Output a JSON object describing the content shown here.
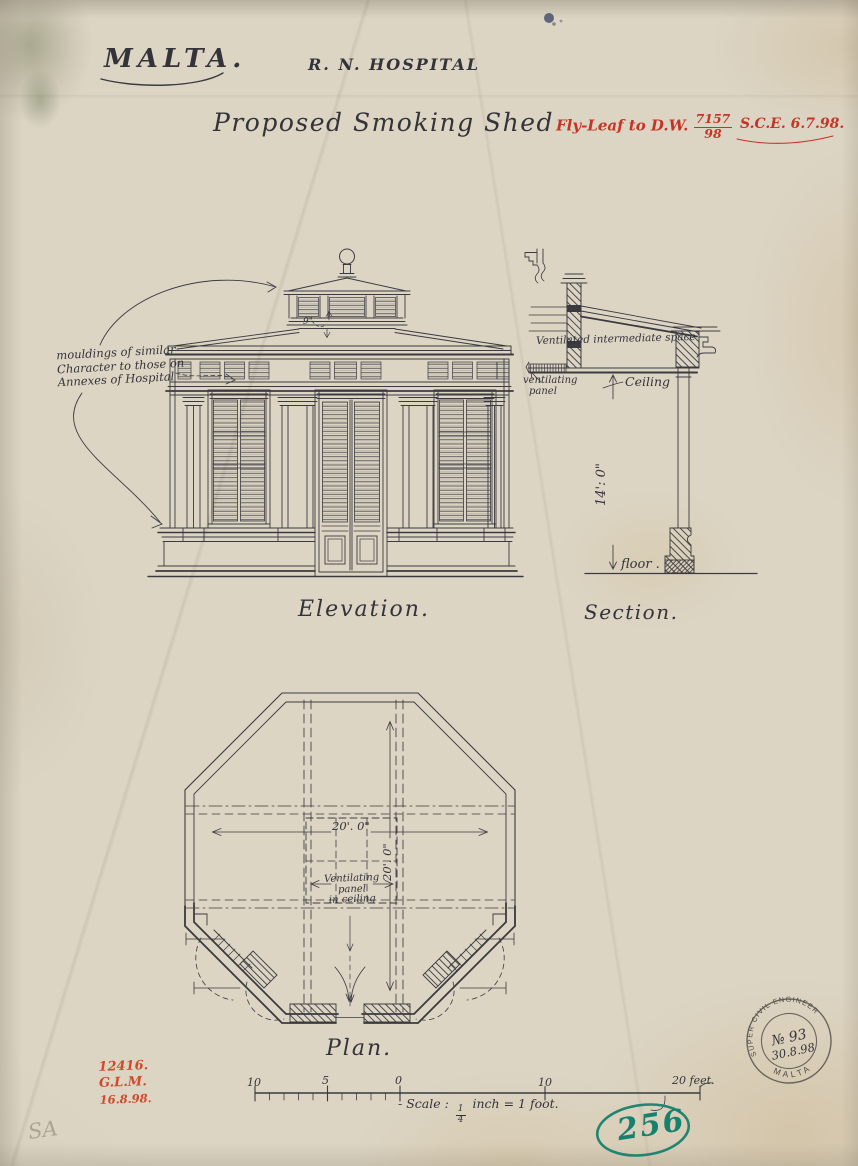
{
  "header": {
    "location": "MALTA.",
    "institution": "R. N. HOSPITAL",
    "title": "Proposed  Smoking  Shed",
    "fly_leaf_label": "Fly-Leaf to D.W.",
    "fly_leaf_num": "7157",
    "fly_leaf_den": "98",
    "sce_note": "S.C.E. 6.7.98."
  },
  "elevation": {
    "label": "Elevation.",
    "note_line1": "mouldings of similar",
    "note_line2": "Character to those on",
    "note_line3": "Annexes of Hospital",
    "roof_dim": "9\""
  },
  "section": {
    "label": "Section.",
    "note_space": "Ventilated intermediate space",
    "note_panel_line1": "ventilating",
    "note_panel_line2": "panel",
    "note_ceiling": "Ceiling",
    "dim_height": "14': 0\"",
    "note_floor": "floor ."
  },
  "plan": {
    "label": "Plan.",
    "dim_width": "20'. 0\"",
    "dim_depth": "20'. 0\"",
    "vent_line1": "Ventilating",
    "vent_line2": "panel",
    "vent_line3": "in ceiling"
  },
  "scale_bar": {
    "tick_10_left": "10",
    "tick_5": "5",
    "tick_0": "0",
    "tick_10_right": "10",
    "tick_20": "20 feet.",
    "caption_prefix": "- Scale :",
    "fraction_num": "1",
    "fraction_den": "4",
    "caption_suffix": "inch = 1 foot."
  },
  "stamps": {
    "red_line1": "12416.",
    "red_line2": "G.L.M.",
    "red_line3": "16.8.98.",
    "round_top": "SUPER CIVIL ENGINEER",
    "round_number": "№ 93",
    "round_date": "30.8.98",
    "round_bottom": "MALTA",
    "file_number": "256",
    "pencil": "SA"
  },
  "colors": {
    "ink": "#3b3a40",
    "red": "#c43527",
    "teal": "#17816e",
    "paper": "#dcd5c4"
  }
}
